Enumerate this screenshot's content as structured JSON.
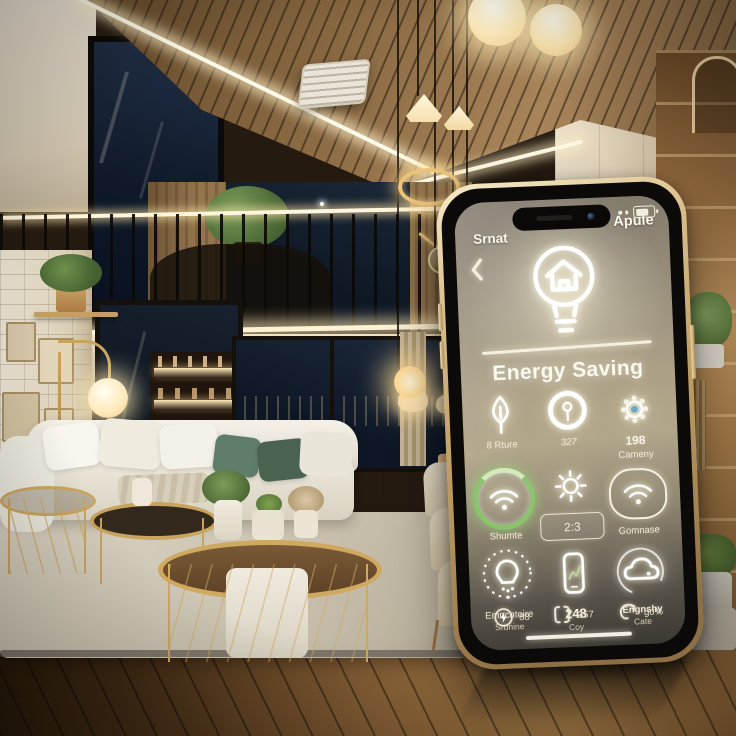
{
  "phone": {
    "header": {
      "left": "Srnat",
      "right": "Apule"
    },
    "title": "Energy Saving",
    "hero_icon": "bulb-home-icon",
    "grid": [
      {
        "icon": "leaf-icon",
        "label": "8 Rture"
      },
      {
        "icon": "sensor-ring-icon",
        "label": "327"
      },
      {
        "icon": "gear-icon",
        "value": "198",
        "label": "Cameny"
      },
      {
        "icon": "wifi-icon",
        "label": "Shumte"
      },
      {
        "icon": "sun-icon",
        "value": "2:3"
      },
      {
        "icon": "wifi-squircle-icon",
        "label": "Gomnase"
      },
      {
        "icon": "bulb-dotted-icon",
        "label": "Emncntoire",
        "sublabel": "Srdnine"
      },
      {
        "icon": "phone-chart-icon",
        "value": "248",
        "sublabel": "Coy"
      },
      {
        "icon": "cloud-icon",
        "label": "Engnshy",
        "sublabel": "Cate"
      }
    ],
    "footer_stats": [
      {
        "icon": "bolt-circle-icon",
        "value": "88"
      },
      {
        "icon": "bracket-square-icon",
        "value": "357"
      },
      {
        "icon": "swirl-arrow-icon",
        "value": "go%"
      }
    ],
    "colors": {
      "accent_green": "#8cc36d",
      "frame_gold": "#d9bd88",
      "screen_warm": "#b2a68a"
    }
  },
  "scene": {
    "colors": {
      "ceiling_wood": "#8a6a43",
      "floor_wood": "#7d5730",
      "sofa_white": "#eee9dc",
      "rug": "#d0c8b6",
      "accent_gold": "#cda75e",
      "night_window": "#0e1828",
      "led_warm": "#fff3d4",
      "pillow_green": "#5f7d69"
    }
  }
}
